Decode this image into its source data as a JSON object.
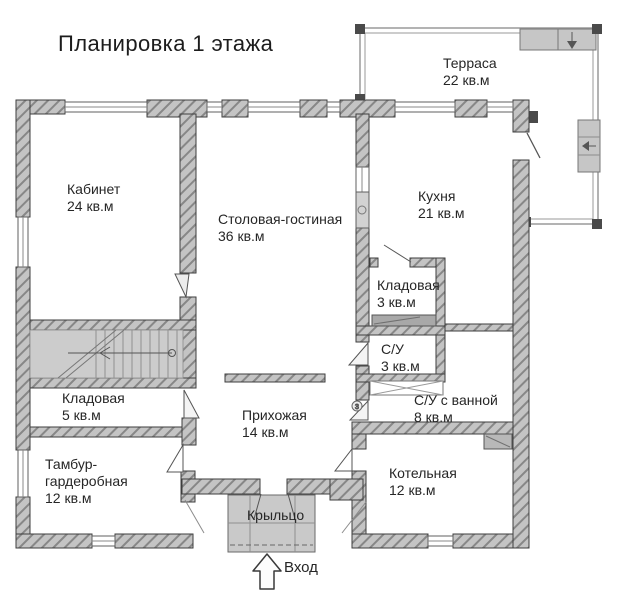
{
  "title": "Планировка 1 этажа",
  "entrance": {
    "label": "Вход"
  },
  "rooms": [
    {
      "id": "terrace",
      "name": "Терраса",
      "area": "22 кв.м"
    },
    {
      "id": "office",
      "name": "Кабинет",
      "area": "24 кв.м"
    },
    {
      "id": "dining-living",
      "name": "Столовая-гостиная",
      "area": "36 кв.м"
    },
    {
      "id": "kitchen",
      "name": "Кухня",
      "area": "21 кв.м"
    },
    {
      "id": "pantry-small",
      "name": "Кладовая",
      "area": "3 кв.м"
    },
    {
      "id": "wc",
      "name": "С/У",
      "area": "3 кв.м"
    },
    {
      "id": "wc-bath",
      "name": "С/У с ванной",
      "area": "8 кв.м"
    },
    {
      "id": "pantry",
      "name": "Кладовая",
      "area": "5 кв.м"
    },
    {
      "id": "hallway",
      "name": "Прихожая",
      "area": "14 кв.м"
    },
    {
      "id": "vestibule",
      "name": "Тамбур-гардеробная",
      "area": "12 кв.м"
    },
    {
      "id": "boiler",
      "name": "Котельная",
      "area": "12 кв.м"
    },
    {
      "id": "porch",
      "name": "Крыльцо",
      "area": ""
    }
  ],
  "annotations": {
    "door_mark": "3"
  },
  "colors": {
    "wall_fill": "#c4c4c4",
    "wall_hatch": "#878787",
    "wall_outline": "#3e3e3e",
    "floor_light": "#c9c9c9",
    "text": "#262626"
  }
}
